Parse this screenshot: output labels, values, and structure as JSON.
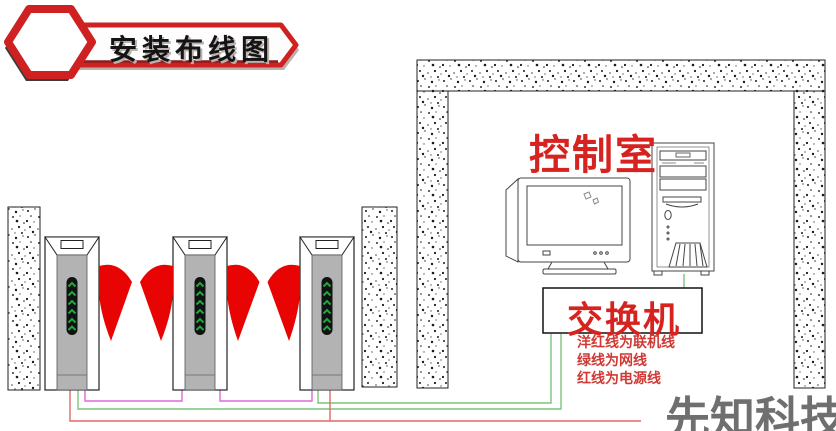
{
  "banner": {
    "title": "安装布线图"
  },
  "control_room": {
    "label": "控制室"
  },
  "switch_box": {
    "label": "交换机"
  },
  "cable_legend": {
    "line1": "洋红线为联机线",
    "line2": "绿线为网线",
    "line3": "红线为电源线"
  },
  "watermark": {
    "text": "先知科技"
  },
  "colors": {
    "banner_red": "#cf2121",
    "label_red": "#d62320",
    "legend_red": "#cf3a35",
    "wing_red": "#e80402",
    "cable_magenta": "#de6ad8",
    "cable_green": "#7cc47c",
    "cable_red": "#dd6a66",
    "cabinet_gray": "#b3b3b3",
    "led_green": "#1fa83c",
    "watermark_gray": "#6f6f6f"
  },
  "icons": {
    "hexagon_badge": "red hexagon outline",
    "ribbon": "pointed red ribbon banner",
    "turnstile_gate": "flap barrier cabinet with green arrow panel",
    "flap_wing": "red fan-shaped flap wing",
    "wall": "speckled concrete wall strip",
    "crt_monitor": "CRT monitor line drawing",
    "pc_tower": "PC tower line drawing",
    "switch_rect": "switch box rectangle"
  }
}
